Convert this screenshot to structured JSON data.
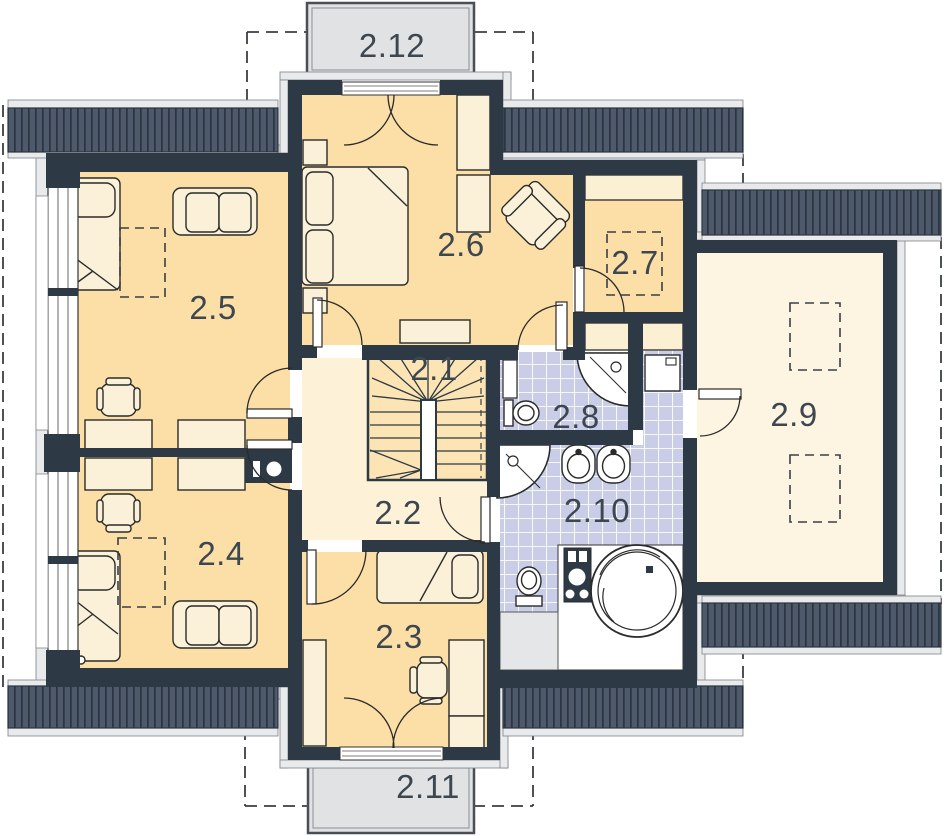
{
  "plan_title": "Upper floor plan",
  "rooms": [
    {
      "label": "2.1"
    },
    {
      "label": "2.2"
    },
    {
      "label": "2.3"
    },
    {
      "label": "2.4"
    },
    {
      "label": "2.5"
    },
    {
      "label": "2.6"
    },
    {
      "label": "2.7"
    },
    {
      "label": "2.8"
    },
    {
      "label": "2.9"
    },
    {
      "label": "2.10"
    },
    {
      "label": "2.11"
    },
    {
      "label": "2.12"
    }
  ],
  "colors": {
    "wall": "#2d3944",
    "floor_warm": "#fbdfa7",
    "floor_light": "#fdf2d7",
    "floor_pale": "#fdf5e2",
    "stair_floor": "#fce4b4",
    "tile": "#c9cde7",
    "roof_hatch": "#4e5a6b",
    "roof_hatch_stripe": "#2b3540",
    "plaster": "#e9eaeb",
    "balcony": "#e0e2e4",
    "furniture": "#faf1d8",
    "fixture": "#ffffff",
    "label_text": "#3d4750"
  }
}
